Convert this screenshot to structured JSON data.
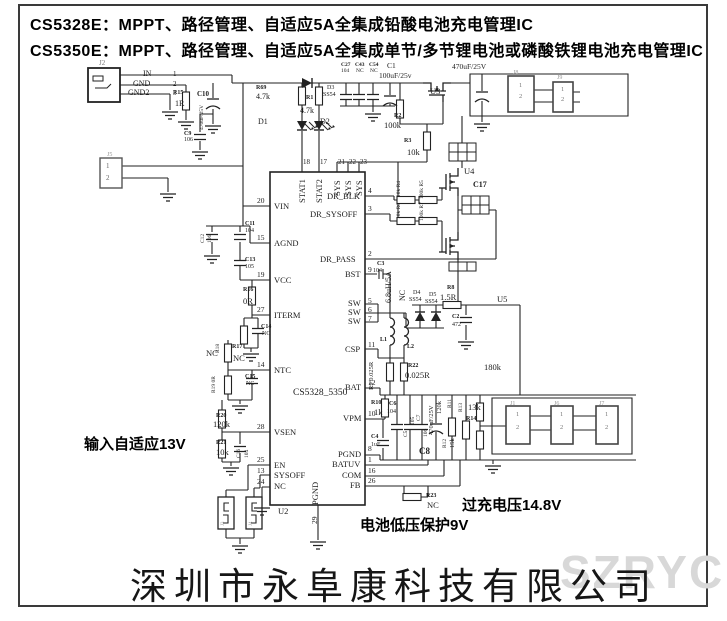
{
  "header": {
    "line1": "CS5328E：MPPT、路径管理、自适应5A全集成铅酸电池充电管理IC",
    "line2": "CS5350E：MPPT、路径管理、自适应5A全集成单节/多节锂电池或磷酸铁锂电池充电管理IC"
  },
  "annotations": {
    "input": "输入自适应13V",
    "overcharge": "过充电压14.8V",
    "undervolt": "电池低压保护9V"
  },
  "footer": {
    "company": "深圳市永阜康科技有限公司",
    "watermark": "SZRYC"
  },
  "colors": {
    "wire": "#222222",
    "muted_label": "#999999",
    "watermark": "#d8d8d8"
  },
  "labels": [
    {
      "t": "J2",
      "x": 99,
      "y": 60,
      "s": 7,
      "c": "#777"
    },
    {
      "t": "IN",
      "x": 143,
      "y": 70,
      "s": 8
    },
    {
      "t": "GND",
      "x": 133,
      "y": 80,
      "s": 8
    },
    {
      "t": "GND2",
      "x": 128,
      "y": 89,
      "s": 8
    },
    {
      "t": "1",
      "x": 173,
      "y": 71,
      "s": 7
    },
    {
      "t": "2",
      "x": 173,
      "y": 81,
      "s": 7
    },
    {
      "t": "3",
      "x": 173,
      "y": 90,
      "s": 7
    },
    {
      "t": "R15",
      "x": 173,
      "y": 90,
      "s": 6,
      "b": 1
    },
    {
      "t": "1R",
      "x": 175,
      "y": 100,
      "s": 8
    },
    {
      "t": "C10",
      "x": 197,
      "y": 91,
      "s": 7,
      "b": 1
    },
    {
      "t": "470uF/25V",
      "x": 200,
      "y": 130,
      "r": -90,
      "s": 5.5
    },
    {
      "t": "C9",
      "x": 184,
      "y": 131,
      "s": 6,
      "b": 1
    },
    {
      "t": "106",
      "x": 184,
      "y": 137,
      "s": 6
    },
    {
      "t": "J5",
      "x": 107,
      "y": 152,
      "s": 6,
      "c": "#999"
    },
    {
      "t": "1",
      "x": 106,
      "y": 163,
      "s": 7,
      "c": "#666"
    },
    {
      "t": "2",
      "x": 106,
      "y": 175,
      "s": 7,
      "c": "#666"
    },
    {
      "t": "R69",
      "x": 256,
      "y": 85,
      "s": 6,
      "b": 1
    },
    {
      "t": "4.7k",
      "x": 256,
      "y": 93,
      "s": 8
    },
    {
      "t": "R1",
      "x": 306,
      "y": 95,
      "s": 6,
      "b": 1
    },
    {
      "t": "4.7k",
      "x": 300,
      "y": 107,
      "s": 8
    },
    {
      "t": "D1",
      "x": 258,
      "y": 118,
      "s": 8
    },
    {
      "t": "D2",
      "x": 320,
      "y": 118,
      "s": 8
    },
    {
      "t": "D3",
      "x": 327,
      "y": 85,
      "s": 6
    },
    {
      "t": "SS54",
      "x": 323,
      "y": 92,
      "s": 6
    },
    {
      "t": "C27",
      "x": 341,
      "y": 63,
      "s": 5.5,
      "b": 1
    },
    {
      "t": "104",
      "x": 341,
      "y": 69,
      "s": 5.5
    },
    {
      "t": "C43",
      "x": 355,
      "y": 63,
      "s": 5.5,
      "b": 1
    },
    {
      "t": "NC",
      "x": 356,
      "y": 69,
      "s": 5.5
    },
    {
      "t": "C54",
      "x": 369,
      "y": 63,
      "s": 5.5,
      "b": 1
    },
    {
      "t": "NC",
      "x": 370,
      "y": 69,
      "s": 5.5
    },
    {
      "t": "C1",
      "x": 387,
      "y": 62,
      "s": 7.5
    },
    {
      "t": "100uF/25v",
      "x": 379,
      "y": 72,
      "s": 7.5
    },
    {
      "t": "470uF/25V",
      "x": 452,
      "y": 63,
      "s": 7.5
    },
    {
      "t": "U3",
      "x": 430,
      "y": 87,
      "s": 8.5
    },
    {
      "t": "R2",
      "x": 394,
      "y": 113,
      "s": 6,
      "b": 1
    },
    {
      "t": "100k",
      "x": 384,
      "y": 121,
      "s": 8.5
    },
    {
      "t": "R3",
      "x": 404,
      "y": 138,
      "s": 6,
      "b": 1
    },
    {
      "t": "10k",
      "x": 407,
      "y": 148,
      "s": 8.5
    },
    {
      "t": "J8",
      "x": 513,
      "y": 70,
      "s": 6,
      "c": "#999"
    },
    {
      "t": "1",
      "x": 519,
      "y": 83,
      "s": 6.5,
      "c": "#777"
    },
    {
      "t": "2",
      "x": 519,
      "y": 94,
      "s": 6.5,
      "c": "#777"
    },
    {
      "t": "J9",
      "x": 557,
      "y": 75,
      "s": 6,
      "c": "#999"
    },
    {
      "t": "1",
      "x": 561,
      "y": 87,
      "s": 6.5,
      "c": "#777"
    },
    {
      "t": "2",
      "x": 561,
      "y": 97,
      "s": 6.5,
      "c": "#777"
    },
    {
      "t": "U4",
      "x": 464,
      "y": 167,
      "s": 8.5
    },
    {
      "t": "C17",
      "x": 473,
      "y": 181,
      "s": 8,
      "b": 1
    },
    {
      "t": "10k R4",
      "x": 397,
      "y": 197,
      "r": -90,
      "s": 5.5
    },
    {
      "t": "100k R5",
      "x": 420,
      "y": 199,
      "r": -90,
      "s": 5.5
    },
    {
      "t": "10k R6",
      "x": 397,
      "y": 219,
      "r": -90,
      "s": 5.5
    },
    {
      "t": "100k R7",
      "x": 420,
      "y": 221,
      "r": -90,
      "s": 5.5
    },
    {
      "t": "18",
      "x": 303,
      "y": 159,
      "s": 7
    },
    {
      "t": "17",
      "x": 320,
      "y": 159,
      "s": 7
    },
    {
      "t": "21",
      "x": 338,
      "y": 159,
      "s": 7
    },
    {
      "t": "22",
      "x": 349,
      "y": 159,
      "s": 7
    },
    {
      "t": "23",
      "x": 360,
      "y": 159,
      "s": 7
    },
    {
      "t": "STAT1",
      "x": 298,
      "y": 203,
      "r": -90,
      "s": 8.5
    },
    {
      "t": "STAT2",
      "x": 315,
      "y": 203,
      "r": -90,
      "s": 8.5
    },
    {
      "t": "SYS",
      "x": 333,
      "y": 196,
      "r": -90,
      "s": 8.5
    },
    {
      "t": "SYS",
      "x": 344,
      "y": 196,
      "r": -90,
      "s": 8.5
    },
    {
      "t": "SYS",
      "x": 355,
      "y": 196,
      "r": -90,
      "s": 8.5
    },
    {
      "t": "20",
      "x": 257,
      "y": 197,
      "s": 7.5
    },
    {
      "t": "VIN",
      "x": 274,
      "y": 202,
      "s": 8.5
    },
    {
      "t": "15",
      "x": 257,
      "y": 234,
      "s": 7.5
    },
    {
      "t": "AGND",
      "x": 274,
      "y": 239,
      "s": 8.5
    },
    {
      "t": "19",
      "x": 257,
      "y": 271,
      "s": 7.5
    },
    {
      "t": "VCC",
      "x": 274,
      "y": 276,
      "s": 8.5
    },
    {
      "t": "27",
      "x": 257,
      "y": 306,
      "s": 7.5
    },
    {
      "t": "ITERM",
      "x": 274,
      "y": 311,
      "s": 8.5
    },
    {
      "t": "14",
      "x": 257,
      "y": 361,
      "s": 7.5
    },
    {
      "t": "NTC",
      "x": 274,
      "y": 366,
      "s": 8.5
    },
    {
      "t": "28",
      "x": 257,
      "y": 423,
      "s": 7.5
    },
    {
      "t": "VSEN",
      "x": 274,
      "y": 428,
      "s": 8.5
    },
    {
      "t": "25",
      "x": 257,
      "y": 456,
      "s": 7.5
    },
    {
      "t": "EN",
      "x": 274,
      "y": 461,
      "s": 8.5
    },
    {
      "t": "13",
      "x": 257,
      "y": 467,
      "s": 7.5
    },
    {
      "t": "SYSOFF",
      "x": 274,
      "y": 471,
      "s": 8.5
    },
    {
      "t": "24",
      "x": 257,
      "y": 478,
      "s": 7.5
    },
    {
      "t": "NC",
      "x": 274,
      "y": 482,
      "s": 8.5
    },
    {
      "t": "DR_BLK",
      "x": 327,
      "y": 192,
      "s": 8.5
    },
    {
      "t": "4",
      "x": 368,
      "y": 187,
      "s": 7.5
    },
    {
      "t": "DR_SYSOFF",
      "x": 310,
      "y": 210,
      "s": 8.5
    },
    {
      "t": "3",
      "x": 368,
      "y": 205,
      "s": 7.5
    },
    {
      "t": "DR_PASS",
      "x": 320,
      "y": 255,
      "s": 8.5
    },
    {
      "t": "2",
      "x": 368,
      "y": 250,
      "s": 7.5
    },
    {
      "t": "BST",
      "x": 345,
      "y": 270,
      "s": 8.5
    },
    {
      "t": "9",
      "x": 368,
      "y": 266,
      "s": 7.5
    },
    {
      "t": "SW",
      "x": 348,
      "y": 299,
      "s": 8.5
    },
    {
      "t": "5",
      "x": 368,
      "y": 297,
      "s": 7.5
    },
    {
      "t": "SW",
      "x": 348,
      "y": 308,
      "s": 8.5
    },
    {
      "t": "6",
      "x": 368,
      "y": 306,
      "s": 7.5
    },
    {
      "t": "SW",
      "x": 348,
      "y": 317,
      "s": 8.5
    },
    {
      "t": "7",
      "x": 368,
      "y": 315,
      "s": 7.5
    },
    {
      "t": "CSP",
      "x": 345,
      "y": 345,
      "s": 8.5
    },
    {
      "t": "11",
      "x": 368,
      "y": 341,
      "s": 7.5
    },
    {
      "t": "BAT",
      "x": 345,
      "y": 383,
      "s": 8.5
    },
    {
      "t": "12",
      "x": 368,
      "y": 379,
      "s": 7.5
    },
    {
      "t": "VPM",
      "x": 343,
      "y": 414,
      "s": 8.5
    },
    {
      "t": "10",
      "x": 368,
      "y": 410,
      "s": 7.5
    },
    {
      "t": "PGND",
      "x": 338,
      "y": 450,
      "s": 8.5
    },
    {
      "t": "8",
      "x": 368,
      "y": 445,
      "s": 7.5
    },
    {
      "t": "BATUV",
      "x": 332,
      "y": 460,
      "s": 8.5
    },
    {
      "t": "1",
      "x": 368,
      "y": 456,
      "s": 7.5
    },
    {
      "t": "COM",
      "x": 342,
      "y": 471,
      "s": 8.5
    },
    {
      "t": "16",
      "x": 368,
      "y": 467,
      "s": 7.5
    },
    {
      "t": "FB",
      "x": 350,
      "y": 481,
      "s": 8.5
    },
    {
      "t": "26",
      "x": 368,
      "y": 477,
      "s": 7.5
    },
    {
      "t": "CS5328_5350",
      "x": 293,
      "y": 389,
      "s": 9.5
    },
    {
      "t": "PGND",
      "x": 311,
      "y": 505,
      "r": -90,
      "s": 8.5
    },
    {
      "t": "29",
      "x": 311,
      "y": 524,
      "r": -90,
      "s": 7.5
    },
    {
      "t": "U2",
      "x": 278,
      "y": 507,
      "s": 8.5
    },
    {
      "t": "C12",
      "x": 201,
      "y": 243,
      "r": -90,
      "s": 5.5
    },
    {
      "t": "106",
      "x": 208,
      "y": 243,
      "r": -90,
      "s": 5.5
    },
    {
      "t": "C11",
      "x": 245,
      "y": 221,
      "s": 6,
      "b": 1
    },
    {
      "t": "104",
      "x": 245,
      "y": 228,
      "s": 6
    },
    {
      "t": "C13",
      "x": 245,
      "y": 257,
      "s": 6,
      "b": 1
    },
    {
      "t": "105",
      "x": 245,
      "y": 264,
      "s": 6
    },
    {
      "t": "R16",
      "x": 243,
      "y": 287,
      "s": 6,
      "b": 1
    },
    {
      "t": "0R",
      "x": 243,
      "y": 297,
      "s": 8.5
    },
    {
      "t": "C14",
      "x": 261,
      "y": 324,
      "s": 6,
      "b": 1
    },
    {
      "t": "NC",
      "x": 262,
      "y": 331,
      "s": 6
    },
    {
      "t": "R17",
      "x": 232,
      "y": 344,
      "s": 6,
      "b": 1
    },
    {
      "t": "NC",
      "x": 233,
      "y": 354,
      "s": 8.5
    },
    {
      "t": "R18",
      "x": 216,
      "y": 353,
      "r": -90,
      "s": 5.5
    },
    {
      "t": "NC",
      "x": 206,
      "y": 349,
      "s": 8.5
    },
    {
      "t": "R19 0R",
      "x": 212,
      "y": 393,
      "r": -90,
      "s": 5.5
    },
    {
      "t": "C15",
      "x": 245,
      "y": 374,
      "s": 6,
      "b": 1
    },
    {
      "t": "NC",
      "x": 246,
      "y": 381,
      "s": 6
    },
    {
      "t": "R20",
      "x": 216,
      "y": 413,
      "s": 6,
      "b": 1
    },
    {
      "t": "120k",
      "x": 213,
      "y": 420,
      "s": 8.5
    },
    {
      "t": "R21",
      "x": 216,
      "y": 440,
      "s": 6,
      "b": 1
    },
    {
      "t": "10k",
      "x": 216,
      "y": 448,
      "s": 8.5
    },
    {
      "t": "C16",
      "x": 237,
      "y": 458,
      "r": -90,
      "s": 5.5
    },
    {
      "t": "104",
      "x": 245,
      "y": 458,
      "r": -90,
      "s": 5.5
    },
    {
      "t": "C3",
      "x": 377,
      "y": 261,
      "s": 6,
      "b": 1
    },
    {
      "t": "104",
      "x": 373,
      "y": 268,
      "s": 6
    },
    {
      "t": "6.8uH/5A",
      "x": 385,
      "y": 303,
      "r": -90,
      "s": 8
    },
    {
      "t": "NC",
      "x": 399,
      "y": 301,
      "r": -90,
      "s": 8
    },
    {
      "t": "D4",
      "x": 413,
      "y": 290,
      "s": 6
    },
    {
      "t": "SS54",
      "x": 409,
      "y": 297,
      "s": 6
    },
    {
      "t": "D5",
      "x": 429,
      "y": 292,
      "s": 6
    },
    {
      "t": "SS54",
      "x": 425,
      "y": 299,
      "s": 6
    },
    {
      "t": "R8",
      "x": 447,
      "y": 285,
      "s": 6,
      "b": 1
    },
    {
      "t": "1.5R",
      "x": 440,
      "y": 293,
      "s": 8.5
    },
    {
      "t": "C2",
      "x": 452,
      "y": 314,
      "s": 6,
      "b": 1
    },
    {
      "t": "472",
      "x": 452,
      "y": 322,
      "s": 6
    },
    {
      "t": "U5",
      "x": 497,
      "y": 295,
      "s": 8.5
    },
    {
      "t": "L1",
      "x": 380,
      "y": 337,
      "s": 6,
      "b": 1
    },
    {
      "t": "L2",
      "x": 407,
      "y": 344,
      "s": 6,
      "b": 1
    },
    {
      "t": "R9 0.025R",
      "x": 369,
      "y": 390,
      "r": -90,
      "s": 6.5
    },
    {
      "t": "R22",
      "x": 408,
      "y": 363,
      "s": 6,
      "b": 1
    },
    {
      "t": "0.025R",
      "x": 405,
      "y": 371,
      "s": 8.5
    },
    {
      "t": "180k",
      "x": 484,
      "y": 363,
      "s": 8.5
    },
    {
      "t": "R10",
      "x": 371,
      "y": 400,
      "s": 6,
      "b": 1
    },
    {
      "t": "1k",
      "x": 374,
      "y": 408,
      "s": 8.5
    },
    {
      "t": "C6",
      "x": 389,
      "y": 401,
      "s": 6,
      "b": 1
    },
    {
      "t": "104",
      "x": 387,
      "y": 409,
      "s": 6
    },
    {
      "t": "C5",
      "x": 404,
      "y": 437,
      "r": -90,
      "s": 5.5
    },
    {
      "t": "105",
      "x": 411,
      "y": 425,
      "r": -90,
      "s": 5.5
    },
    {
      "t": "C7",
      "x": 417,
      "y": 421,
      "r": -90,
      "s": 5.5
    },
    {
      "t": "106",
      "x": 424,
      "y": 437,
      "r": -90,
      "s": 5.5
    },
    {
      "t": "470uF/25V",
      "x": 429,
      "y": 435,
      "r": -90,
      "s": 6.5
    },
    {
      "t": "120k",
      "x": 437,
      "y": 414,
      "r": -90,
      "s": 6.5
    },
    {
      "t": "R11",
      "x": 448,
      "y": 408,
      "r": -90,
      "s": 5.5
    },
    {
      "t": "C8",
      "x": 419,
      "y": 447,
      "s": 9,
      "b": 1
    },
    {
      "t": "R12",
      "x": 443,
      "y": 448,
      "r": -90,
      "s": 5.5
    },
    {
      "t": "15k",
      "x": 450,
      "y": 448,
      "r": -90,
      "s": 6.5
    },
    {
      "t": "C4",
      "x": 371,
      "y": 434,
      "s": 6,
      "b": 1
    },
    {
      "t": "1uF",
      "x": 371,
      "y": 442,
      "s": 6
    },
    {
      "t": "R13",
      "x": 459,
      "y": 412,
      "r": -90,
      "s": 5.5
    },
    {
      "t": "13k",
      "x": 468,
      "y": 403,
      "s": 8.5
    },
    {
      "t": "R14",
      "x": 466,
      "y": 416,
      "s": 6,
      "b": 1
    },
    {
      "t": "R23",
      "x": 426,
      "y": 493,
      "s": 6,
      "b": 1
    },
    {
      "t": "NC",
      "x": 427,
      "y": 501,
      "s": 8.5
    },
    {
      "t": "J1",
      "x": 510,
      "y": 401,
      "s": 6,
      "c": "#999"
    },
    {
      "t": "1",
      "x": 516,
      "y": 412,
      "s": 6.5,
      "c": "#777"
    },
    {
      "t": "2",
      "x": 516,
      "y": 425,
      "s": 6.5,
      "c": "#777"
    },
    {
      "t": "J6",
      "x": 554,
      "y": 401,
      "s": 6,
      "c": "#999"
    },
    {
      "t": "1",
      "x": 560,
      "y": 412,
      "s": 6.5,
      "c": "#777"
    },
    {
      "t": "2",
      "x": 560,
      "y": 425,
      "s": 6.5,
      "c": "#777"
    },
    {
      "t": "J7",
      "x": 599,
      "y": 401,
      "s": 6,
      "c": "#999"
    },
    {
      "t": "1",
      "x": 605,
      "y": 412,
      "s": 6.5,
      "c": "#777"
    },
    {
      "t": "2",
      "x": 605,
      "y": 425,
      "s": 6.5,
      "c": "#777"
    },
    {
      "t": "J3",
      "x": 221,
      "y": 526,
      "r": -90,
      "s": 5,
      "c": "#999"
    },
    {
      "t": "J4",
      "x": 249,
      "y": 526,
      "r": -90,
      "s": 5,
      "c": "#999"
    }
  ]
}
